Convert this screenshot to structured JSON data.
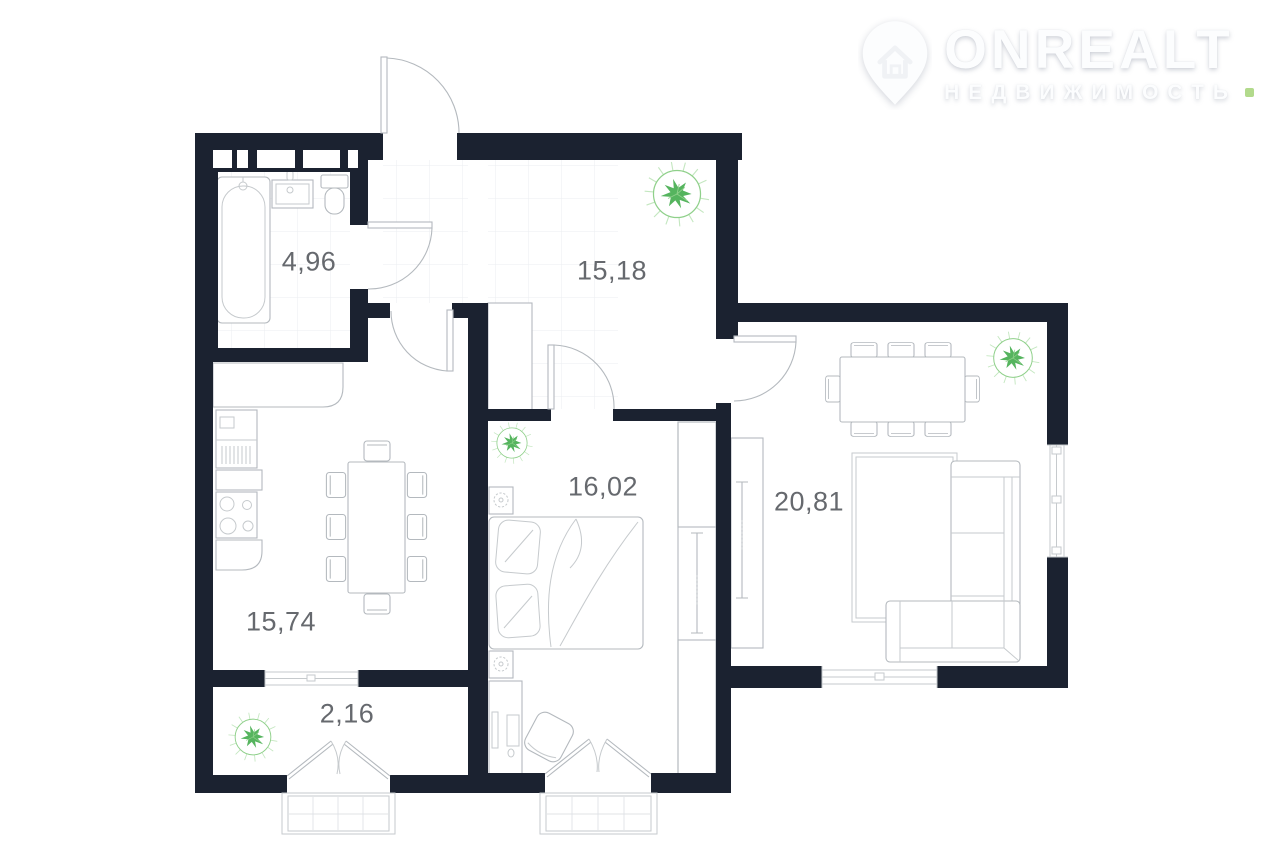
{
  "watermark": {
    "brand": "ONREALT",
    "tagline": "НЕДВИЖИМОСТЬ"
  },
  "floor_plan": {
    "type": "apartment-floor-plan",
    "rooms": [
      {
        "name": "bathroom",
        "area_label": "4,96"
      },
      {
        "name": "hallway",
        "area_label": "15,18"
      },
      {
        "name": "kitchen-dining",
        "area_label": "15,74"
      },
      {
        "name": "bedroom",
        "area_label": "16,02"
      },
      {
        "name": "living-room",
        "area_label": "20,81"
      },
      {
        "name": "balcony",
        "area_label": "2,16"
      }
    ],
    "fixtures": [
      "bathtub",
      "wash-basin",
      "toilet",
      "kitchen-counter",
      "kitchen-sink-unit",
      "stove",
      "dining-table-8-chairs",
      "dining-table-living-8-chairs",
      "double-bed",
      "nightstand-lamps",
      "desk-with-chair",
      "wardrobes",
      "corner-sofa",
      "rug",
      "plants",
      "entrance-door",
      "french-doors",
      "windows",
      "porches"
    ]
  },
  "theme": {
    "wall": "#1b2230",
    "label": "#66696e",
    "line": "#b4b9be",
    "line_soft": "#c6cacd",
    "tile": "#ebedf0",
    "hatch": "#cfd3d7",
    "plant": "#8fd08a",
    "plant_dark": "#55b45e",
    "plant_light": "#c4e7c0",
    "logo": "#fcfdfe",
    "logo_accent": "#a5d378"
  }
}
